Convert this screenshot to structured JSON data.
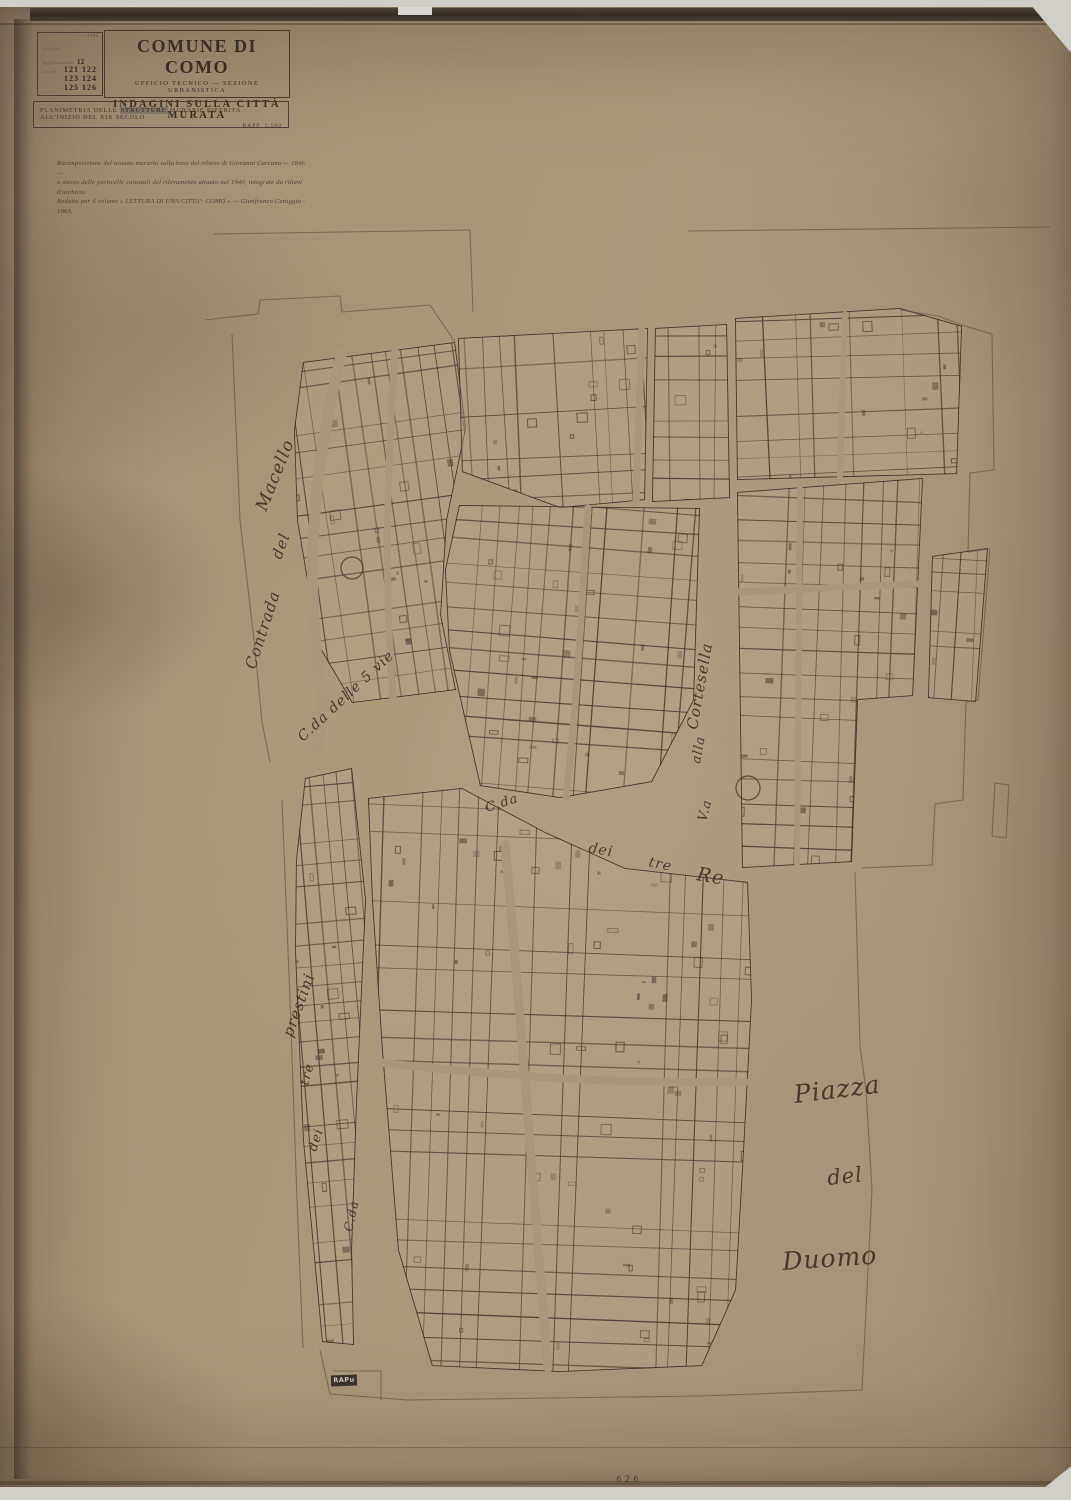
{
  "colors": {
    "paper": "#a79678",
    "ink": "#3c3127",
    "faint_ink": "#56483a",
    "scanner": "#cfcec9"
  },
  "index_box": {
    "corner_no": "1104",
    "row1_label": "archivio",
    "row2_label": "aggiornamento",
    "row2_value": "12",
    "row3_label": "tavole",
    "plates": [
      "121 122",
      "123 124",
      "125 126"
    ]
  },
  "header": {
    "commune": "COMUNE DI COMO",
    "office": "UFFICIO TECNICO — SEZIONE URBANISTICA",
    "survey": "INDAGINI SULLA CITTÀ MURATA"
  },
  "subtitle": {
    "pre": "PLANIMETRIA DELLE",
    "bold": "STRUTTURE",
    "post": "MURARIE RIFERITA ALL'INIZIO DEL XIX SECOLO",
    "scale": "RAPP. 1:500"
  },
  "note": {
    "line1": "Ricomposizione del tessuto murario sulla base del rilievo di Giovanni Carcano — 1846 —",
    "line2": "a mezzo delle particelle catastali del rilevamento attuato nel 1940, integrate da rilievi d'archivio.",
    "line3": "Redatta per il volume « LETTURA DI UNA CITTA': COMO » — Gianfranco Caniggia - 1963."
  },
  "streets": {
    "macello_1": "Contrada",
    "macello_2": "del",
    "macello_3": "Macello",
    "cinque_vie": "C.da delle 5 vie",
    "cortesella_1": "V.a",
    "cortesella_2": "alla",
    "cortesella_3": "Cortesella",
    "tre_re_1": "C.da",
    "tre_re_2": "dei",
    "tre_re_3": "tre",
    "tre_re_4": "Re",
    "prestini_1": "C.da",
    "prestini_2": "dei",
    "prestini_3": "tre",
    "prestini_4": "prestini",
    "piazza_1": "Piazza",
    "piazza_2": "del",
    "piazza_3": "Duomo"
  },
  "annotations": {
    "top_pencil": "6-6",
    "bottom_pencil": "6 2 6"
  },
  "stamp": {
    "label": "RAPu"
  }
}
